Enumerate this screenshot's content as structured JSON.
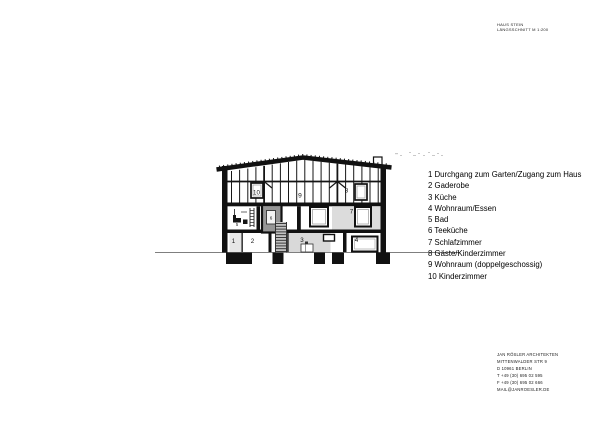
{
  "title_block": {
    "line1": "HAUS STEIN",
    "line2": "LÄNGSSCHNITT M 1:200"
  },
  "legend": {
    "items": [
      "1 Durchgang zum Garten/Zugang zum Haus",
      "2 Gaderobe",
      "3 Küche",
      "4 Wohnraum/Essen",
      "5 Bad",
      "6 Teeküche",
      "7 Schlafzimmer",
      "8 Gäste/Kinderzimmer",
      "9 Wohnraum (doppelgeschossig)",
      "10 Kinderzimmer"
    ]
  },
  "drawing": {
    "room_labels": {
      "r1": "1",
      "r2": "2",
      "r3": "3",
      "r4": "4",
      "r5": "5",
      "r6": "6",
      "r7": "7",
      "r8": "8",
      "r9": "9",
      "r10": "10"
    }
  },
  "contact_block": {
    "lines": [
      "JAN RÖSLER ARCHITEKTEN",
      "MITTENWALDER STR 9",
      "D 10961 BERLIN",
      "T +49 (30) 695 02 595",
      "F +49 (30) 695 02 666",
      "MAIL@JANROESLER.DE"
    ]
  },
  "colors": {
    "ink": "#141414",
    "room_shade": "#d9d9d9",
    "dark_glass": "#969696",
    "stair_fill": "#c2c2c2",
    "faint_marks": "#c9c9c9"
  }
}
